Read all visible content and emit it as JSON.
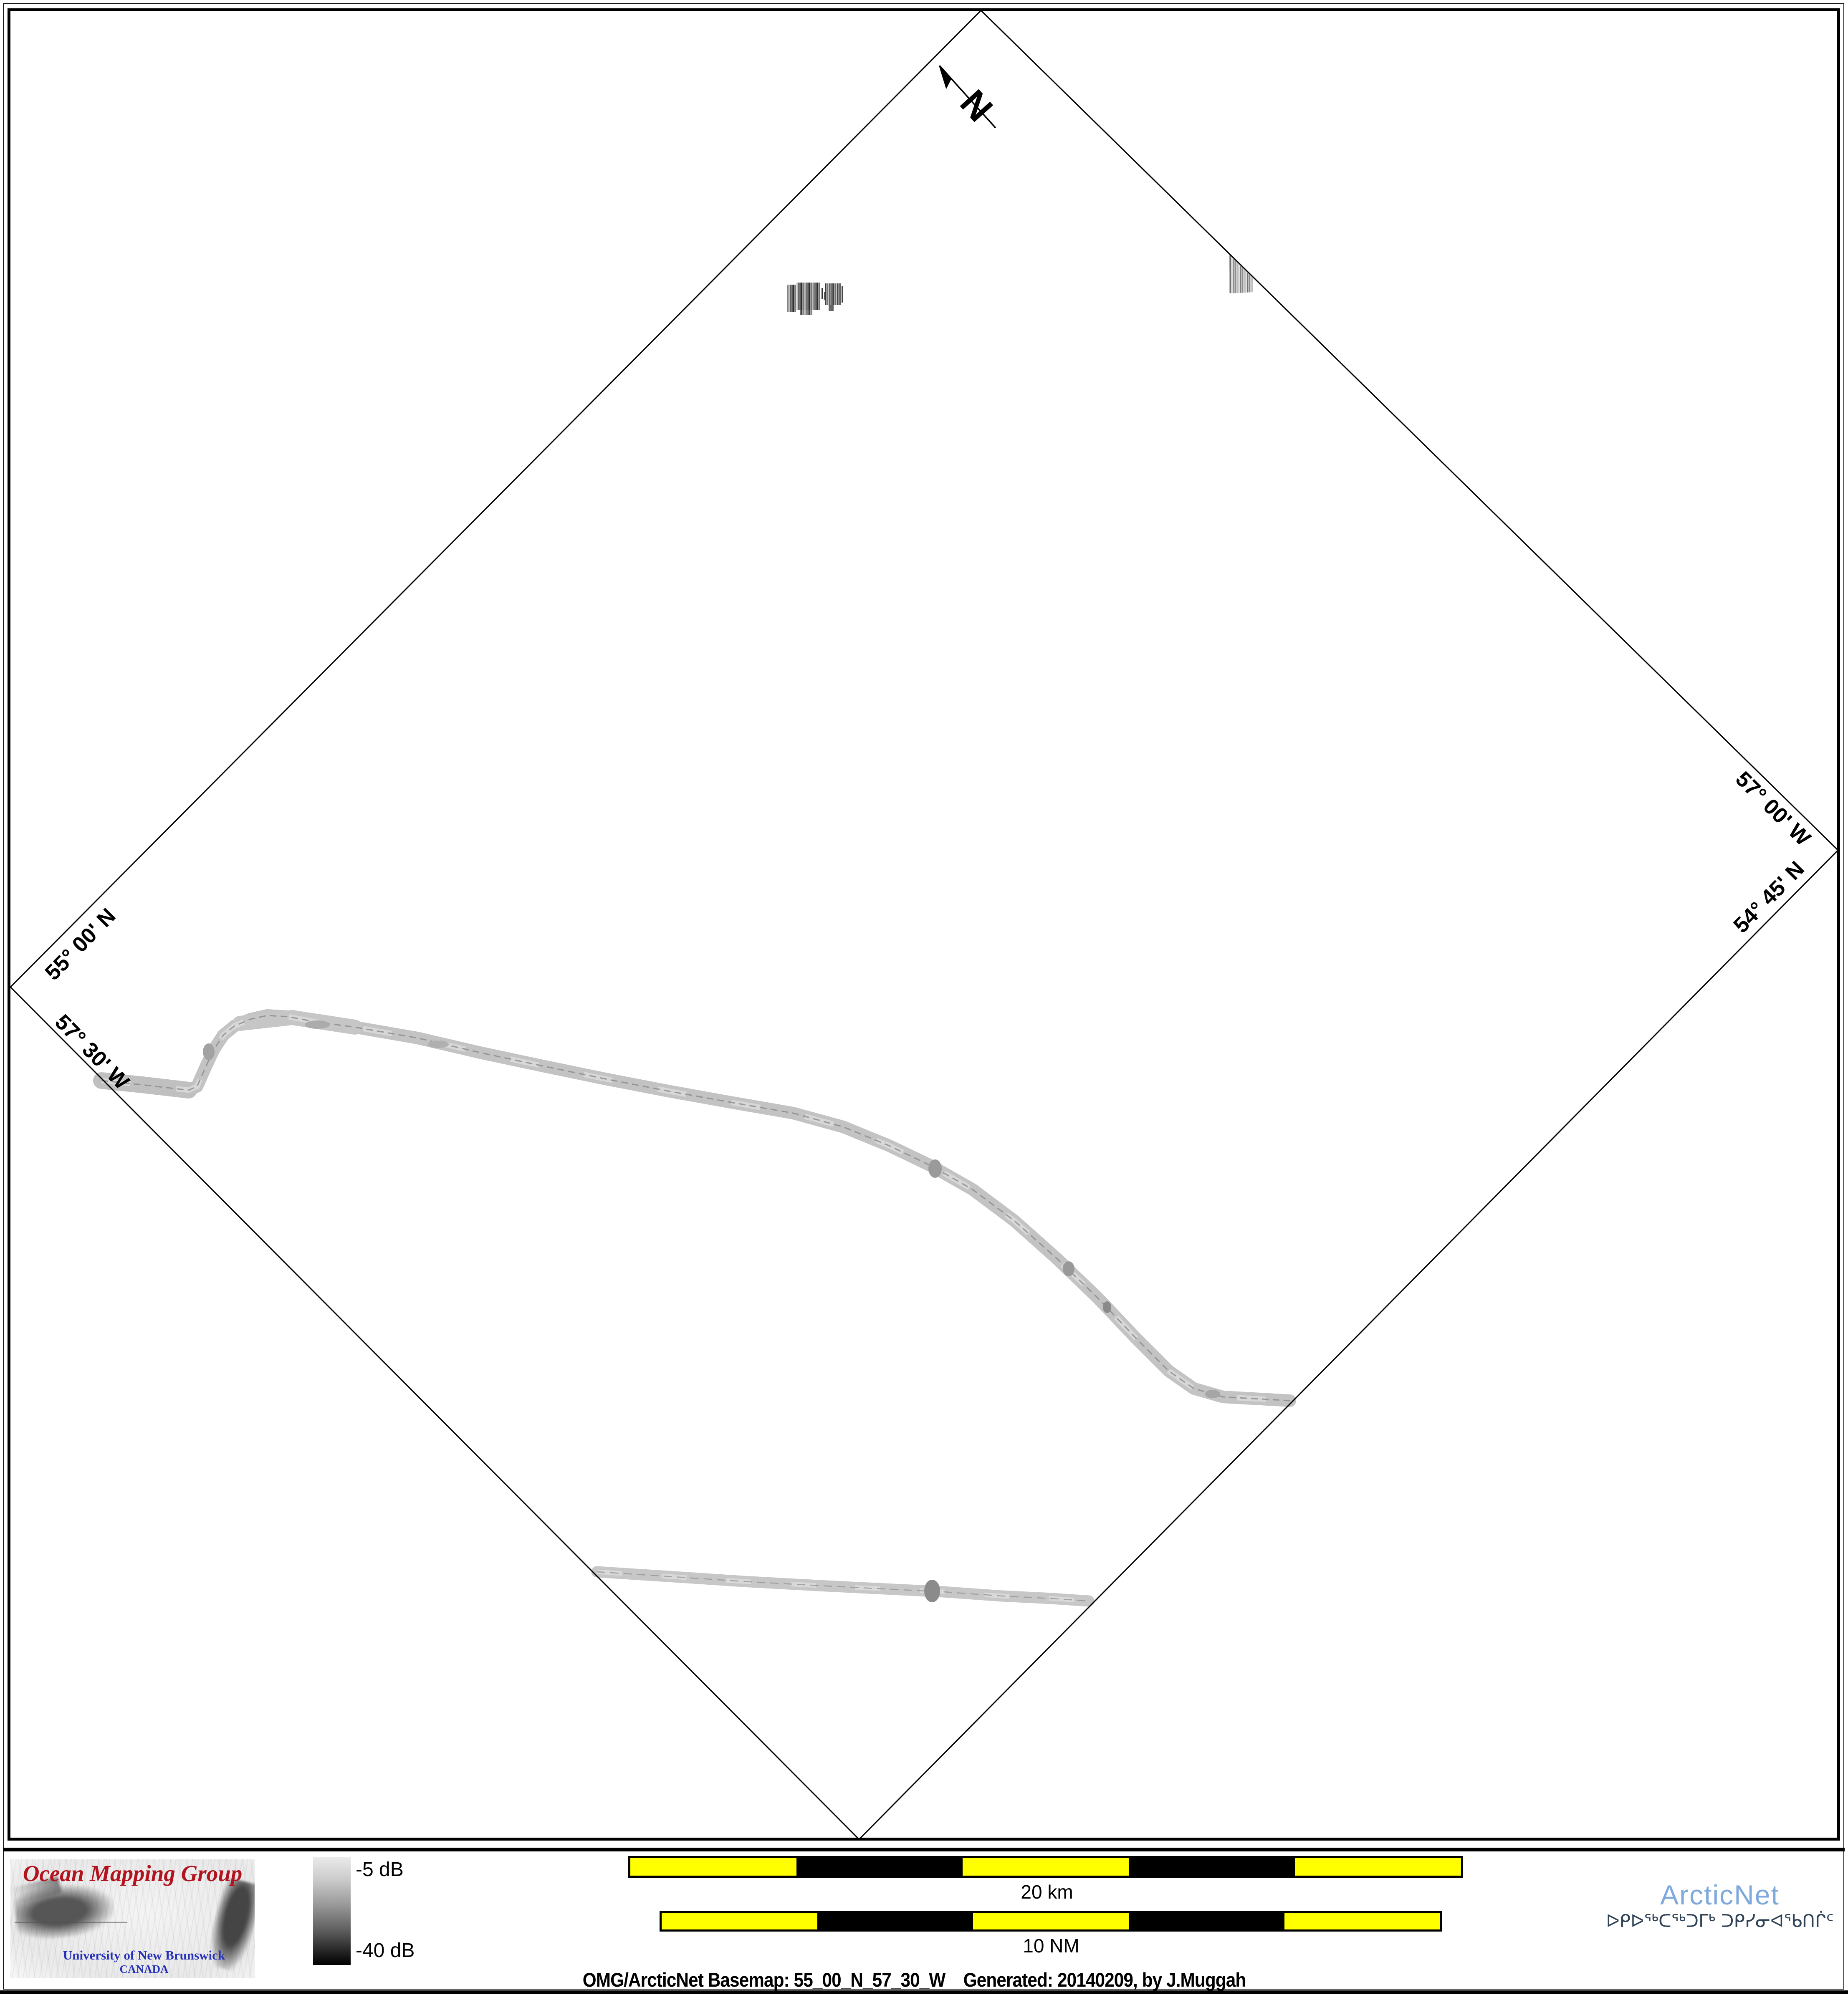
{
  "map": {
    "corner_labels": {
      "north": "55° 00' N",
      "west": "57° 30' W",
      "east": "57° 00' W",
      "south": "54° 45' N"
    },
    "north_arrow_label": "N"
  },
  "legend": {
    "colorbar_top": "-5 dB",
    "colorbar_bottom": "-40 dB"
  },
  "scalebars": {
    "km": {
      "label": "20 km"
    },
    "nm": {
      "label": "10 NM"
    }
  },
  "caption": "OMG/ArcticNet Basemap: 55_00_N_57_30_W    Generated: 20140209, by J.Muggah",
  "logos": {
    "omg": {
      "title": "Ocean Mapping Group",
      "line1": "University of New Brunswick",
      "line2": "CANADA"
    },
    "arcticnet": {
      "name": "ArcticNet",
      "inuktitut": "ᐅᑭᐅᖅᑕᖅᑐᒥᒃ ᑐᑭᓯᓂᐊᖃᑎᒌᑦ"
    }
  },
  "colors": {
    "scalebar_yellow": "#ffff00",
    "scalebar_black": "#000000",
    "omg_red": "#b2141f",
    "omg_blue": "#2430b8",
    "arcticnet_blue": "#7ea9dc",
    "arcticnet_navy": "#2f4257",
    "track_gray": "#c3c3c3"
  }
}
